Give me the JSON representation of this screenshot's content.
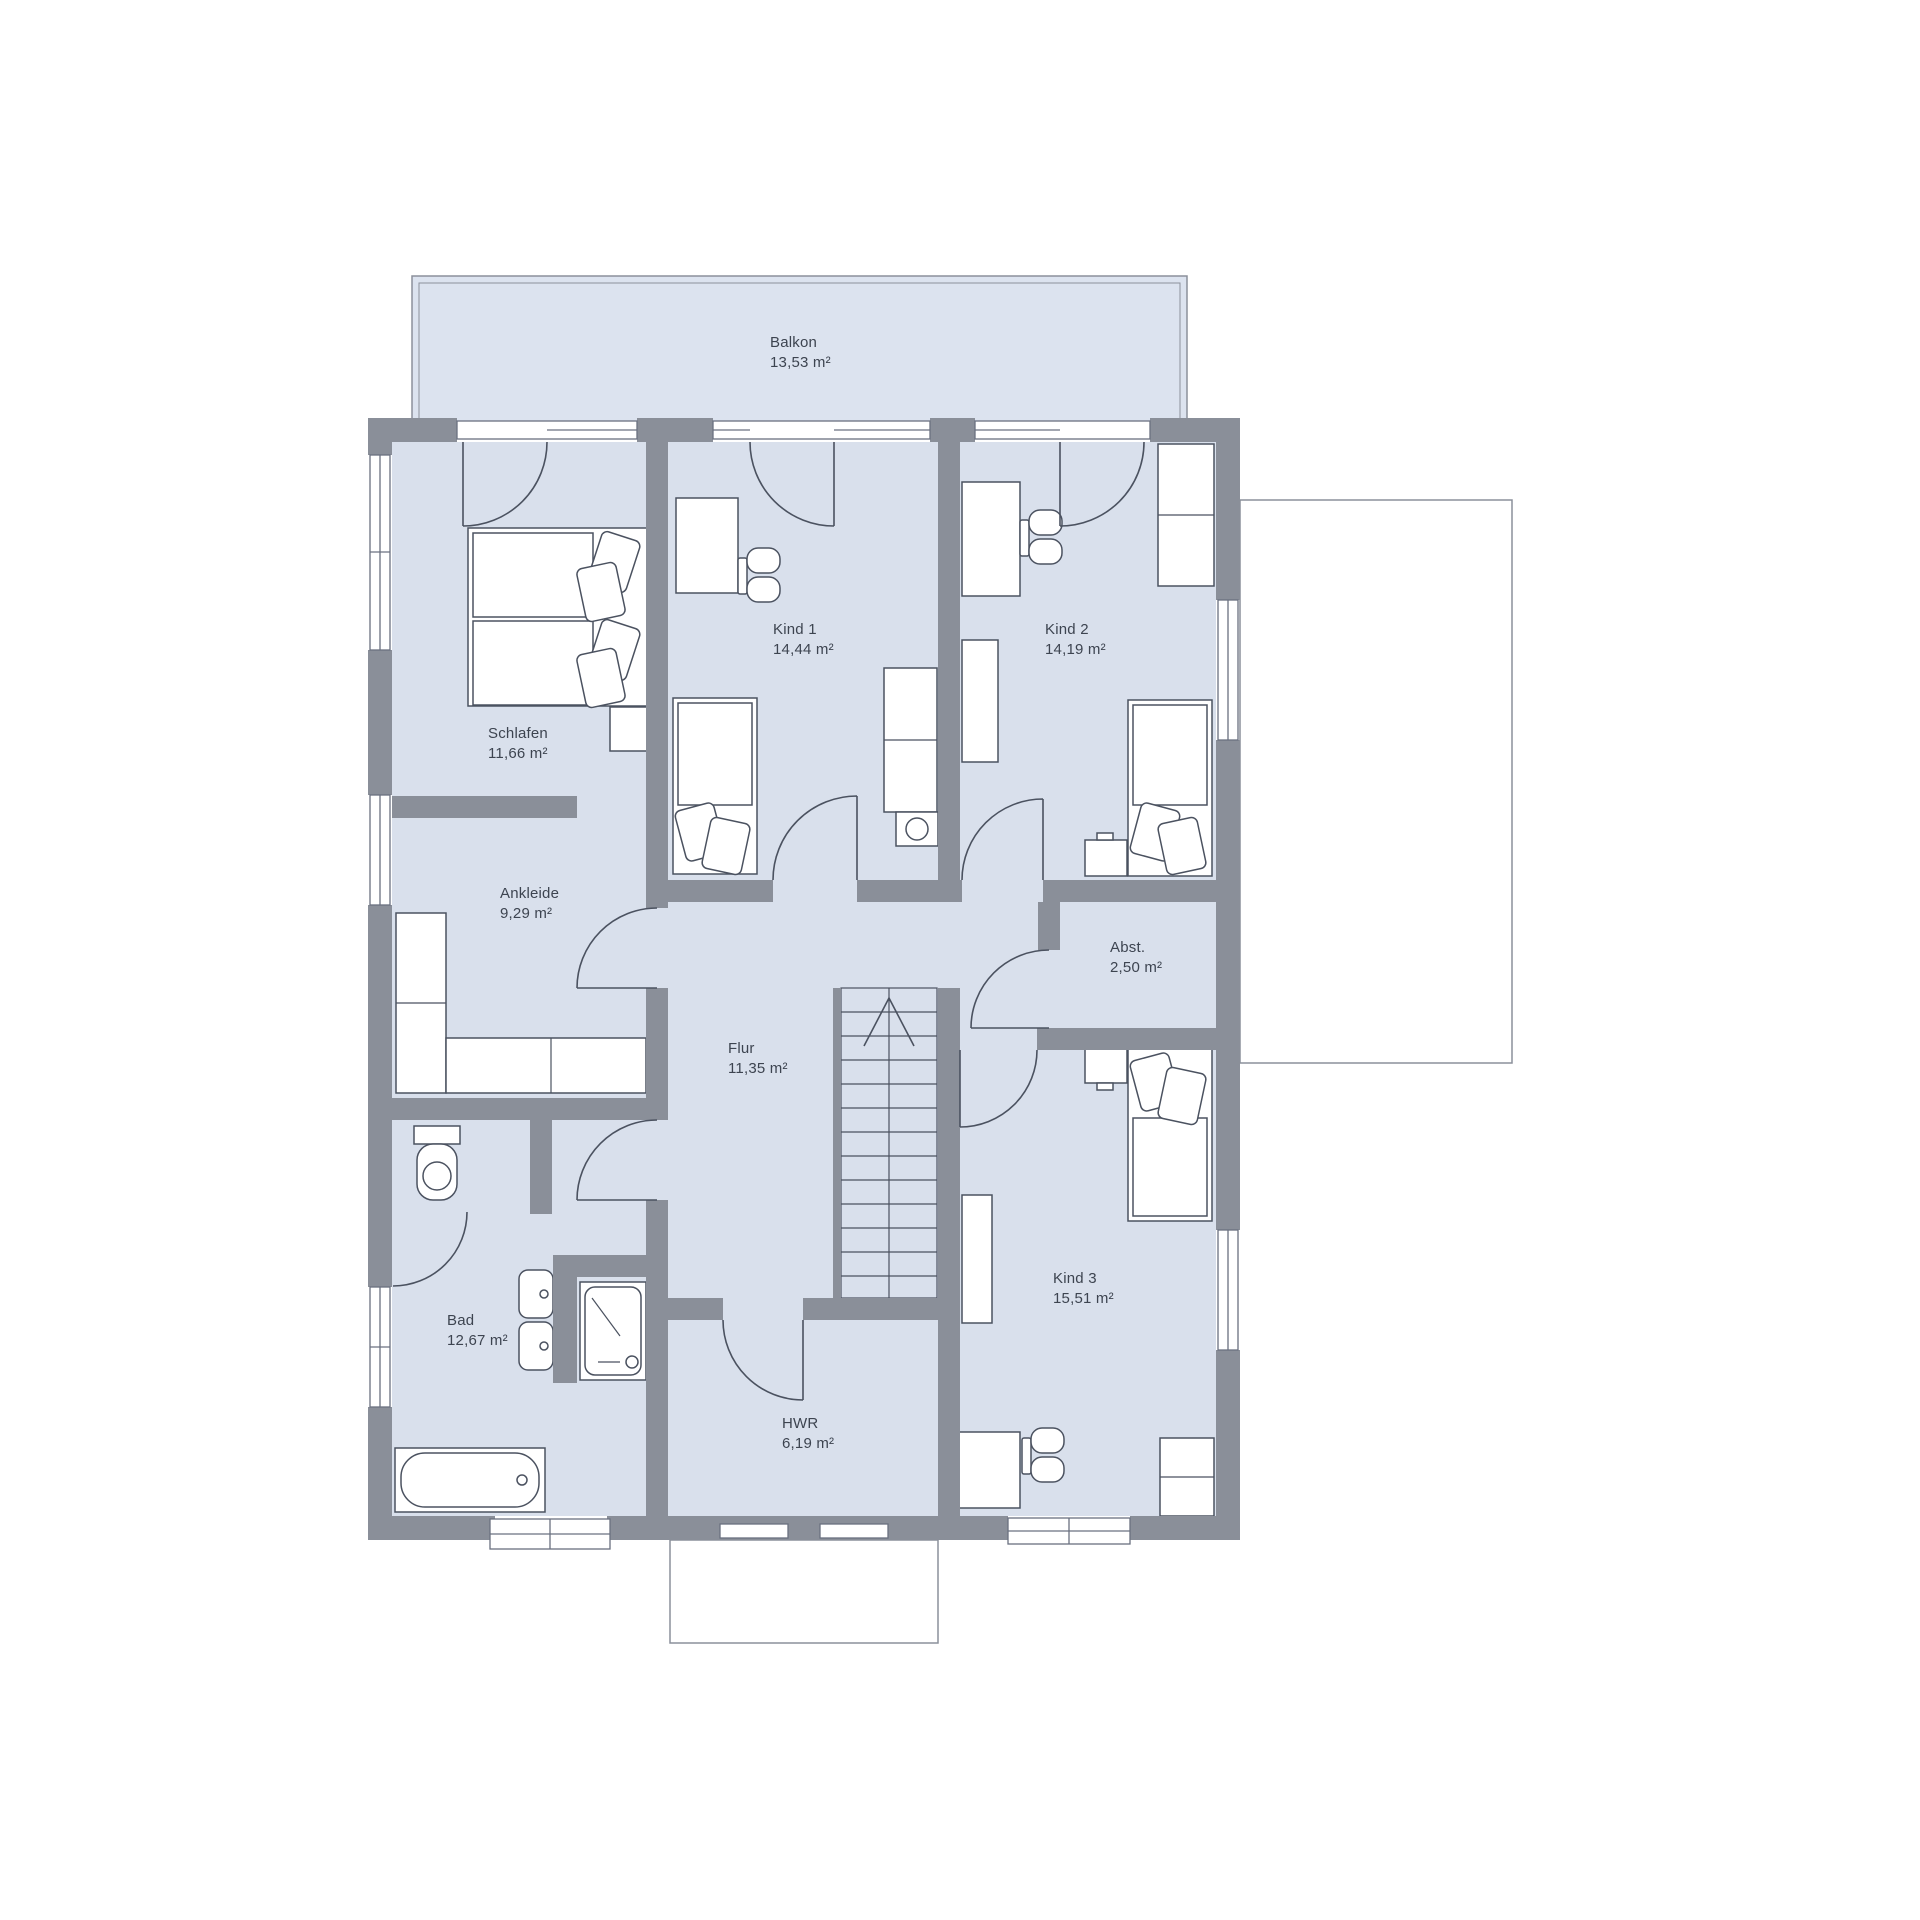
{
  "plan": {
    "rooms": [
      {
        "id": "balkon",
        "name": "Balkon",
        "area": "13,53 m²"
      },
      {
        "id": "schlafen",
        "name": "Schlafen",
        "area": "11,66 m²"
      },
      {
        "id": "kind1",
        "name": "Kind 1",
        "area": "14,44 m²"
      },
      {
        "id": "kind2",
        "name": "Kind 2",
        "area": "14,19 m²"
      },
      {
        "id": "ankleide",
        "name": "Ankleide",
        "area": "9,29 m²"
      },
      {
        "id": "abst",
        "name": "Abst.",
        "area": "2,50 m²"
      },
      {
        "id": "flur",
        "name": "Flur",
        "area": "11,35 m²"
      },
      {
        "id": "bad",
        "name": "Bad",
        "area": "12,67 m²"
      },
      {
        "id": "kind3",
        "name": "Kind 3",
        "area": "15,51 m²"
      },
      {
        "id": "hwr",
        "name": "HWR",
        "area": "6,19 m²"
      }
    ],
    "colors": {
      "wall": "#8a8f99",
      "floor": "#d9e0ec",
      "balcony": "#dce3ef",
      "line": "#4b5260",
      "text": "#3d4450"
    }
  }
}
